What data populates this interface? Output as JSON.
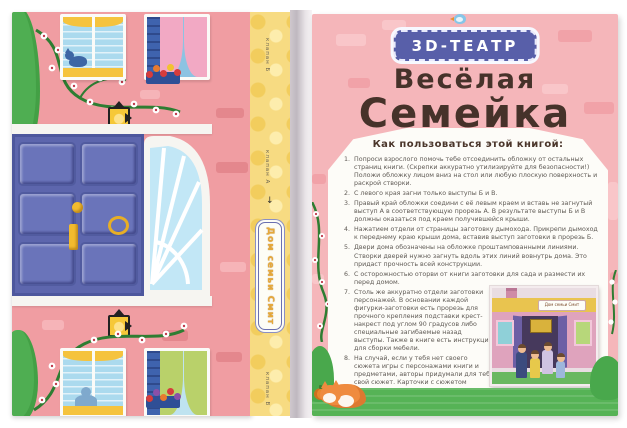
{
  "left_page": {
    "description": "book cover unfolded as house facade",
    "spine": {
      "flap_top_label": "клапан Б",
      "flap_middle_label": "клапан А",
      "flap_bottom_label": "клапан В",
      "house_sign": "Дом семьи Смит"
    }
  },
  "right_page": {
    "badge_label": "3D-ТЕАТР",
    "title_line1": "Весёлая",
    "title_line2": "Семейка",
    "howto": {
      "heading": "Как пользоваться этой книгой:",
      "items": [
        "Попроси взрослого помочь тебе отсоединить обложку от остальных страниц книги. (Скрепки аккуратно утилизируйте для безопасности!) Положи обложку лицом вниз на стол или любую плоскую поверхность и раскрой створки.",
        "С левого края загни только выступы Б и В.",
        "Правый край обложки соедини с её левым краем и вставь не загнутый выступ А в соответствующую прорезь А. В результате выступы Б и В должны оказаться под краем получившейся крыши.",
        "Нажатием отдели от страницы заготовку дымохода. Прикрепи дымоход к переднему краю крыши дома, вставив выступ заготовки в прорезь Б.",
        "Двери дома обозначены на обложке проштампованными линиями. Створки дверей нужно загнуть вдоль этих линий вовнутрь дома. Это придаст прочность всей конструкции.",
        "С осторожностью оторви от книги заготовки для сада и размести их перед домом.",
        "Столь же аккуратно отдели заготовки персонажей. В основании каждой фигурки-заготовки есть прорезь для прочного крепления подставки крест-накрест под углом 90 градусов либо специальные загибаемые назад выступы. Также в книге есть инструкции для сборки мебели.",
        "На случай, если у тебя нет своего сюжета игры с персонажами книги и предметами, авторы придумали для тебя свой сюжет. Карточки с сюжетом находятся в конце книги."
      ],
      "closing": "Авторы книги желают тебе увлекательной игры!"
    },
    "photo": {
      "sign": "Дом семьи Смит"
    }
  },
  "icons": {
    "arrow_down": "↓"
  },
  "colors": {
    "left_page_pink": "#f09da2",
    "right_page_pink": "#f5b6ba",
    "spine_yellow": "#f7db82",
    "badge_blue": "#585fa9",
    "title_brown": "#46322a",
    "panel_white": "#fdfcf8",
    "door_blue": "#5d66ad",
    "grass_green": "#56b356",
    "accent_yellow": "#f5c33d"
  }
}
